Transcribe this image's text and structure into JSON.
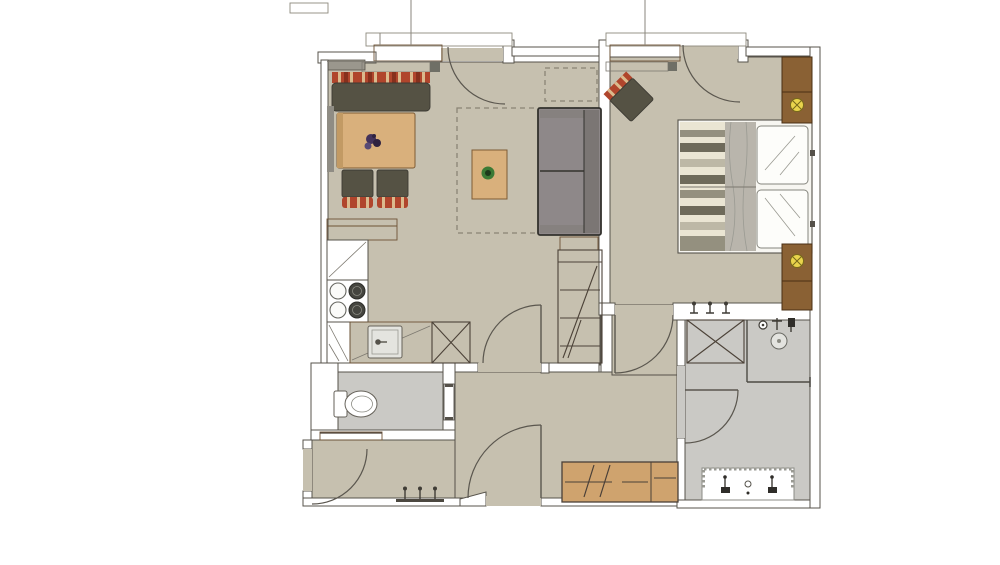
{
  "meta": {
    "title": "apartment-floor-plan",
    "view": "top-down rendered architectural plan, no text labels",
    "background": "#ffffff"
  },
  "palette": {
    "floor_main": "#c6c0af",
    "floor_wet": "#cac9c5",
    "wall_fill": "#ffffff",
    "wall_gray": "#9b978d",
    "wood_light": "#d9b07c",
    "wood_mid": "#cfa36e",
    "wood_dark": "#8a6134",
    "olive": "#555244",
    "sofa_gray": "#8e8889",
    "sofa_back": "#7b7674",
    "sofa_arm": "#86817f",
    "textile_gray": "#b9b5ac",
    "plaid_red": "#b0452c",
    "bed_white": "#f7f6f1",
    "pillow_white": "#fdfdfa",
    "radiator_white": "#ffffff",
    "radiator_box": "#6f6f66",
    "sink_gray": "#e4e4df",
    "burner_dark": "#45453f",
    "plant_green": "#3c7a35",
    "plant_core": "#1d3a1b",
    "floral_purple": "#43325a",
    "lamp_yellow": "#e9d44c",
    "backrest_gray": "#8f8c84",
    "table_edge": "#c29a64"
  },
  "rooms": [
    {
      "name": "living-dining-kitchen",
      "floor": "beige taupe",
      "contents": [
        "corner bench with red plaid cushion",
        "dining table with floral centerpiece",
        "2 chairs with plaid seats",
        "kitchen L-counter",
        "4-burner stove",
        "sink",
        "tall fridge unit (X symbol)",
        "two-seat sofa",
        "coffee table with plant",
        "dashed rug outline",
        "dashed planned cabinet",
        "tall shelf cabinet",
        "balcony door",
        "radiator"
      ]
    },
    {
      "name": "bedroom",
      "floor": "beige taupe",
      "contents": [
        "double bed with striped duvet and two pillows",
        "two wardrobe blocks with lamp symbols",
        "plaid armchair rotated 45deg",
        "balcony door",
        "radiator",
        "3 wall hooks"
      ]
    },
    {
      "name": "bathroom",
      "floor": "light gray tile",
      "contents": [
        "corner shower with head and valves",
        "tall cabinet (X symbol)",
        "double washbasin vanity with 2 faucets",
        "hinged door"
      ]
    },
    {
      "name": "wc",
      "floor": "light gray tile",
      "contents": [
        "toilet with cistern",
        "sliding door"
      ]
    },
    {
      "name": "entry-hall-corridor",
      "floor": "beige taupe",
      "contents": [
        "entrance door",
        "3 coat hooks on rail",
        "wooden bench shelf",
        "sideboard",
        "door to living room",
        "door to bedroom",
        "south door",
        "chamfered corner"
      ]
    }
  ],
  "symbols": {
    "door_swings": 7,
    "stove_burners": 4,
    "coat_hooks": 3,
    "towel_hooks": 3,
    "wardrobe_lamps": 2,
    "faucets": 2
  }
}
